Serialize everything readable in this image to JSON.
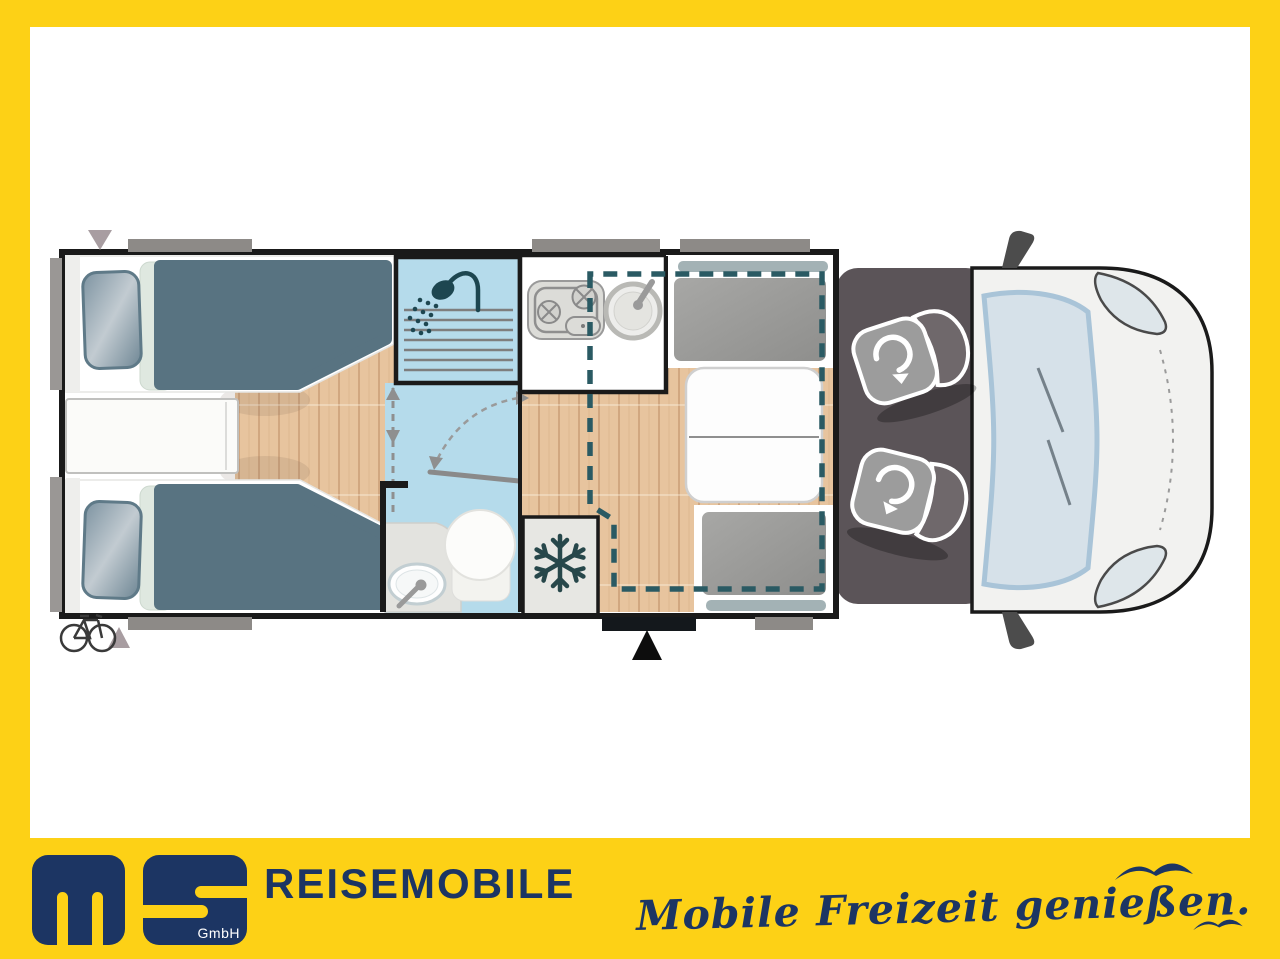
{
  "branding": {
    "company": "REISEMOBILE",
    "slogan": "Mobile Freizeit genießen.",
    "logo": {
      "letters": "ms",
      "suffix": "GmbH"
    },
    "colors": {
      "yellow": "#fdd116",
      "navy": "#1c3563"
    }
  },
  "floorplan": {
    "type": "motorhome-top-view",
    "zones": [
      "twin-single-beds-rear",
      "shower-room",
      "toilet-washroom",
      "kitchen-block",
      "refrigerator",
      "dinette-with-table",
      "drop-down-bed-outline",
      "entry-door",
      "cab-with-two-swivel-seats",
      "vehicle-front"
    ],
    "icons": [
      "shower-icon",
      "snowflake-icon",
      "swivel-arrow-icon",
      "bicycle-icon",
      "entry-arrow-icon",
      "window-marker",
      "bird-icon"
    ],
    "colors": {
      "wall": "#1a1a1a",
      "wood_floor": "#e7c49e",
      "bathroom_blue": "#b5dbeb",
      "bed_blanket": "#587381",
      "seat_gray": "#9c9c9c",
      "cab_floor": "#5b5458",
      "cab_body": "#f2f2f0",
      "windshield": "#d6e1e9",
      "window_bar": "#8d8a87",
      "drop_down_bed_dash": "#2a5a63"
    }
  }
}
